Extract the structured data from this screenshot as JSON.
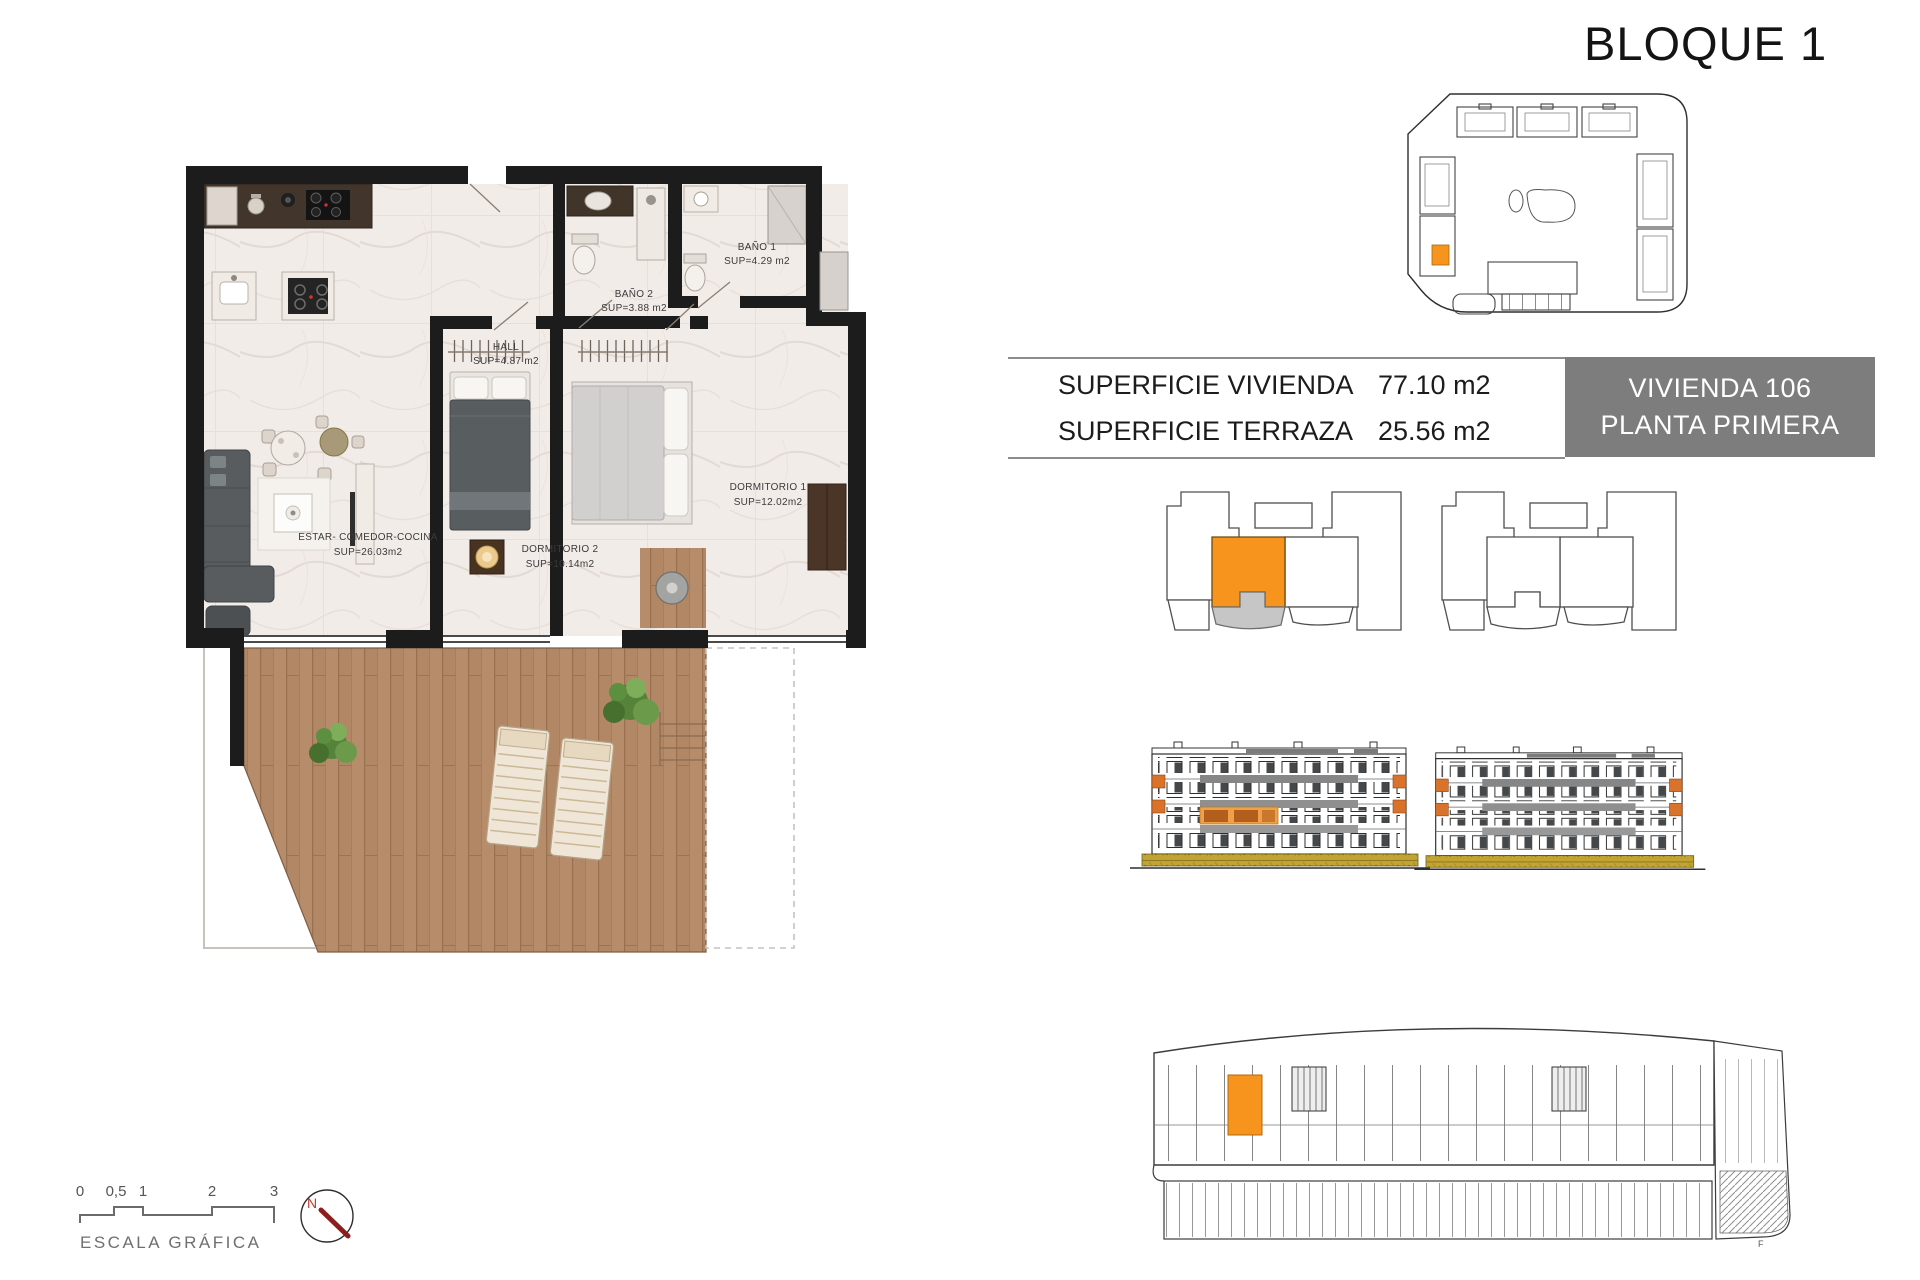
{
  "header": {
    "title": "BLOQUE 1"
  },
  "summary": {
    "rows": [
      {
        "label": "SUPERFICIE VIVIENDA",
        "value": "77.10 m2"
      },
      {
        "label": "SUPERFICIE TERRAZA",
        "value": "25.56 m2"
      }
    ]
  },
  "unit_badge": {
    "name": "VIVIENDA 106",
    "floor": "PLANTA PRIMERA"
  },
  "floor_plan": {
    "rooms": {
      "living": {
        "name": "ESTAR- COMEDOR-COCINA",
        "area": "SUP=26.03m2"
      },
      "hall": {
        "name": "HALL",
        "area": "SUP=4.87 m2"
      },
      "bath2": {
        "name": "BAÑO 2",
        "area": "SUP=3.88 m2"
      },
      "bath1": {
        "name": "BAÑO 1",
        "area": "SUP=4.29 m2"
      },
      "bed2": {
        "name": "DORMITORIO 2",
        "area": "SUP=10.14m2"
      },
      "bed1": {
        "name": "DORMITORIO 1",
        "area": "SUP=12.02m2"
      }
    }
  },
  "scale_bar": {
    "ticks": [
      "0",
      "0,5",
      "1",
      "2",
      "3"
    ],
    "label": "ESCALA GRÁFICA"
  },
  "compass": {
    "north": "N"
  },
  "bottom_plan": {
    "note": "F"
  },
  "colors": {
    "highlight_orange": "#f7941d",
    "badge_gray": "#7d7d7d",
    "terrace_gray": "#c6c6c6",
    "accent_terracotta": "#d9722a",
    "ground_ochre": "#c2a433",
    "compass_red": "#b22222",
    "wall_black": "#1c1c1c"
  }
}
